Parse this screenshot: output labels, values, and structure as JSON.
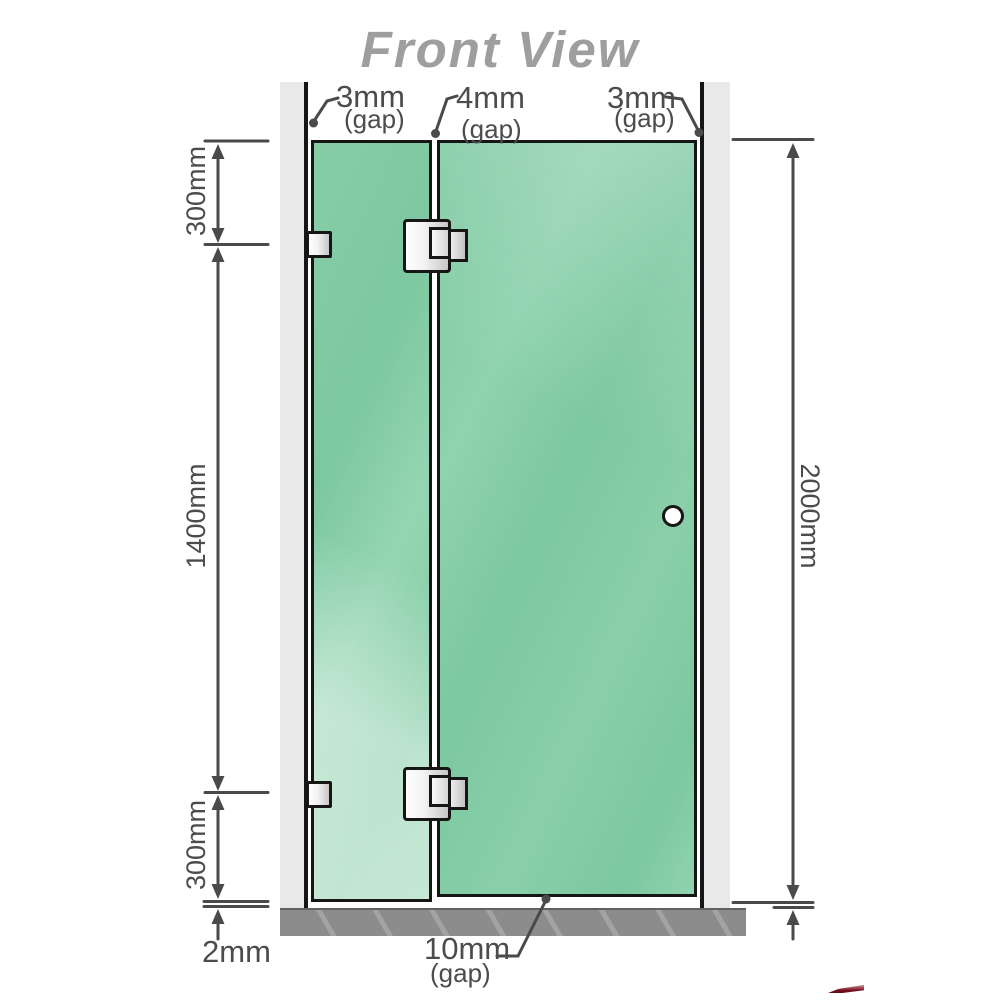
{
  "title": "Front View",
  "labels": {
    "gap_top_left": {
      "value": "3mm",
      "qualifier": "(gap)"
    },
    "gap_top_middle": {
      "value": "4mm",
      "qualifier": "(gap)"
    },
    "gap_top_right": {
      "value": "3mm",
      "qualifier": "(gap)"
    },
    "left_top_segment": "300mm",
    "left_middle_segment": "1400mm",
    "left_bottom_segment": "300mm",
    "right_total_height": "2000mm",
    "bottom_floor_gap": "2mm",
    "gap_bottom_door": {
      "value": "10mm",
      "qualifier": "(gap)"
    }
  },
  "colors": {
    "glass_green": "#7cc8a0",
    "glass_highlight": "#b9e4cc",
    "wall_gray": "#e9e9e9",
    "floor_gray": "#8c8c8c",
    "outline_black": "#161616",
    "dimension_gray": "#4a4a4a",
    "label_gray": "#4c4c4c",
    "title_gray": "#9e9e9e",
    "hardware_silver": "#c7c7c7",
    "watermark_red": "#7a0f1f"
  },
  "icons": {
    "door_knob": "circle-handle-icon",
    "hinge": "hinge-icon",
    "wall_bracket": "glass-clamp-icon",
    "dimension_arrow": "arrow-icon"
  }
}
